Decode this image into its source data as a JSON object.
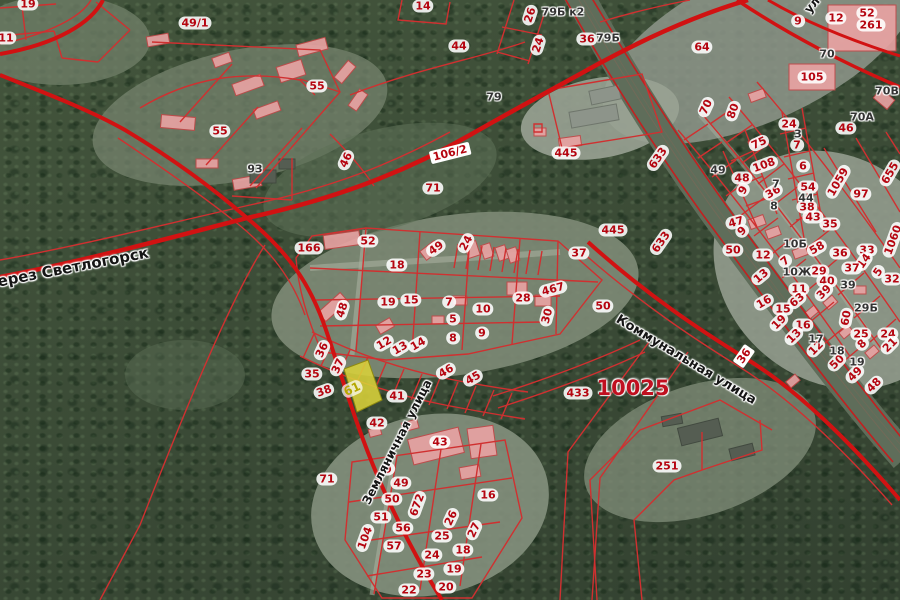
{
  "map": {
    "description": "Public cadastral map over satellite imagery",
    "colors": {
      "boundary_red": "#d11212",
      "thin_boundary_red": "#d03030",
      "parcel_label_red": "#b50510",
      "address_label_gray": "#333333",
      "street_label_black": "#151515",
      "highlight_yellow": "#d9d23a",
      "building_pink": "#e9a3a3",
      "forest_green": "#45523f"
    },
    "highlighted_parcel": {
      "t": "61",
      "x": 352,
      "y": 389,
      "a": -25
    },
    "street_labels": [
      {
        "t": "через Светлогорск",
        "x": 68,
        "y": 268,
        "a": -11,
        "s": 15
      },
      {
        "t": "Коммунальная улица",
        "x": 686,
        "y": 360,
        "a": 31,
        "s": 13
      },
      {
        "t": "Земляничная улица",
        "x": 397,
        "y": 442,
        "a": -63,
        "s": 12
      },
      {
        "t": "ул",
        "x": 812,
        "y": 5,
        "a": -50,
        "s": 12
      }
    ],
    "road_shields": [
      {
        "t": "106/2",
        "x": 450,
        "y": 153,
        "a": -14
      },
      {
        "t": "36",
        "x": 744,
        "y": 356,
        "a": -55
      }
    ],
    "large_area_labels": [
      {
        "t": "10025",
        "x": 633,
        "y": 388,
        "a": 0
      }
    ],
    "parcel_numbers_red": [
      {
        "t": "19",
        "x": 28,
        "y": 4,
        "a": 0
      },
      {
        "t": "11",
        "x": 6,
        "y": 38,
        "a": 0
      },
      {
        "t": "49/1",
        "x": 195,
        "y": 23,
        "a": 0
      },
      {
        "t": "55",
        "x": 220,
        "y": 131,
        "a": 0
      },
      {
        "t": "55",
        "x": 317,
        "y": 86,
        "a": 0
      },
      {
        "t": "14",
        "x": 423,
        "y": 6,
        "a": 0
      },
      {
        "t": "44",
        "x": 459,
        "y": 46,
        "a": 0
      },
      {
        "t": "26",
        "x": 530,
        "y": 15,
        "a": -72
      },
      {
        "t": "24",
        "x": 538,
        "y": 45,
        "a": -72
      },
      {
        "t": "36",
        "x": 587,
        "y": 39,
        "a": 0
      },
      {
        "t": "64",
        "x": 702,
        "y": 47,
        "a": 0
      },
      {
        "t": "9",
        "x": 798,
        "y": 21,
        "a": 0
      },
      {
        "t": "12",
        "x": 836,
        "y": 18,
        "a": 0
      },
      {
        "t": "52",
        "x": 867,
        "y": 13,
        "a": 0
      },
      {
        "t": "261",
        "x": 871,
        "y": 25,
        "a": 0
      },
      {
        "t": "46",
        "x": 346,
        "y": 160,
        "a": -65
      },
      {
        "t": "445",
        "x": 566,
        "y": 153,
        "a": 0
      },
      {
        "t": "71",
        "x": 433,
        "y": 188,
        "a": 0
      },
      {
        "t": "633",
        "x": 658,
        "y": 158,
        "a": -55
      },
      {
        "t": "633",
        "x": 661,
        "y": 242,
        "a": -55
      },
      {
        "t": "445",
        "x": 613,
        "y": 230,
        "a": 0
      },
      {
        "t": "70",
        "x": 706,
        "y": 107,
        "a": -65
      },
      {
        "t": "80",
        "x": 733,
        "y": 111,
        "a": -70
      },
      {
        "t": "105",
        "x": 812,
        "y": 77,
        "a": 0
      },
      {
        "t": "24",
        "x": 789,
        "y": 124,
        "a": 0
      },
      {
        "t": "7",
        "x": 797,
        "y": 145,
        "a": 0
      },
      {
        "t": "46",
        "x": 846,
        "y": 128,
        "a": 0
      },
      {
        "t": "75",
        "x": 759,
        "y": 143,
        "a": -25
      },
      {
        "t": "108",
        "x": 764,
        "y": 165,
        "a": -20
      },
      {
        "t": "36",
        "x": 773,
        "y": 192,
        "a": -30
      },
      {
        "t": "9",
        "x": 743,
        "y": 190,
        "a": -60
      },
      {
        "t": "48",
        "x": 742,
        "y": 178,
        "a": 0
      },
      {
        "t": "6",
        "x": 803,
        "y": 166,
        "a": 0
      },
      {
        "t": "54",
        "x": 808,
        "y": 187,
        "a": 0
      },
      {
        "t": "38",
        "x": 807,
        "y": 207,
        "a": 0
      },
      {
        "t": "43",
        "x": 813,
        "y": 217,
        "a": 0
      },
      {
        "t": "35",
        "x": 830,
        "y": 224,
        "a": 0
      },
      {
        "t": "1059",
        "x": 838,
        "y": 182,
        "a": -60
      },
      {
        "t": "97",
        "x": 861,
        "y": 194,
        "a": 0
      },
      {
        "t": "655",
        "x": 890,
        "y": 173,
        "a": -60
      },
      {
        "t": "1060",
        "x": 893,
        "y": 240,
        "a": -70
      },
      {
        "t": "47",
        "x": 736,
        "y": 222,
        "a": -15
      },
      {
        "t": "9",
        "x": 742,
        "y": 231,
        "a": -45
      },
      {
        "t": "50",
        "x": 733,
        "y": 250,
        "a": 0
      },
      {
        "t": "12",
        "x": 763,
        "y": 255,
        "a": 0
      },
      {
        "t": "13",
        "x": 761,
        "y": 276,
        "a": -40
      },
      {
        "t": "58",
        "x": 817,
        "y": 248,
        "a": -30
      },
      {
        "t": "36",
        "x": 840,
        "y": 253,
        "a": 0
      },
      {
        "t": "33",
        "x": 867,
        "y": 250,
        "a": 0
      },
      {
        "t": "14",
        "x": 864,
        "y": 261,
        "a": -55
      },
      {
        "t": "37",
        "x": 852,
        "y": 268,
        "a": 0
      },
      {
        "t": "5",
        "x": 878,
        "y": 272,
        "a": -55
      },
      {
        "t": "32",
        "x": 892,
        "y": 279,
        "a": 0
      },
      {
        "t": "29",
        "x": 819,
        "y": 271,
        "a": 0
      },
      {
        "t": "40",
        "x": 827,
        "y": 281,
        "a": 0
      },
      {
        "t": "39",
        "x": 824,
        "y": 292,
        "a": -45
      },
      {
        "t": "11",
        "x": 799,
        "y": 289,
        "a": 0
      },
      {
        "t": "63",
        "x": 797,
        "y": 300,
        "a": -40
      },
      {
        "t": "7",
        "x": 785,
        "y": 261,
        "a": -40
      },
      {
        "t": "16",
        "x": 764,
        "y": 302,
        "a": -30
      },
      {
        "t": "15",
        "x": 783,
        "y": 309,
        "a": 0
      },
      {
        "t": "19",
        "x": 779,
        "y": 322,
        "a": -45
      },
      {
        "t": "16",
        "x": 803,
        "y": 325,
        "a": 0
      },
      {
        "t": "13",
        "x": 794,
        "y": 336,
        "a": -45
      },
      {
        "t": "12",
        "x": 816,
        "y": 348,
        "a": -45
      },
      {
        "t": "50",
        "x": 837,
        "y": 362,
        "a": -45
      },
      {
        "t": "49",
        "x": 855,
        "y": 374,
        "a": -45
      },
      {
        "t": "48",
        "x": 874,
        "y": 385,
        "a": -45
      },
      {
        "t": "60",
        "x": 846,
        "y": 318,
        "a": -80
      },
      {
        "t": "25",
        "x": 861,
        "y": 334,
        "a": 0
      },
      {
        "t": "24",
        "x": 888,
        "y": 334,
        "a": 0
      },
      {
        "t": "8",
        "x": 862,
        "y": 344,
        "a": -45
      },
      {
        "t": "21",
        "x": 890,
        "y": 345,
        "a": -45
      },
      {
        "t": "166",
        "x": 309,
        "y": 248,
        "a": 0
      },
      {
        "t": "52",
        "x": 368,
        "y": 241,
        "a": 0
      },
      {
        "t": "49",
        "x": 436,
        "y": 248,
        "a": -35
      },
      {
        "t": "24",
        "x": 466,
        "y": 243,
        "a": -62
      },
      {
        "t": "37",
        "x": 579,
        "y": 253,
        "a": 0
      },
      {
        "t": "18",
        "x": 397,
        "y": 265,
        "a": 0
      },
      {
        "t": "19",
        "x": 388,
        "y": 302,
        "a": 0
      },
      {
        "t": "15",
        "x": 411,
        "y": 300,
        "a": 0
      },
      {
        "t": "48",
        "x": 342,
        "y": 310,
        "a": -72
      },
      {
        "t": "7",
        "x": 449,
        "y": 302,
        "a": 0
      },
      {
        "t": "5",
        "x": 453,
        "y": 319,
        "a": 0
      },
      {
        "t": "8",
        "x": 453,
        "y": 338,
        "a": 0
      },
      {
        "t": "10",
        "x": 483,
        "y": 309,
        "a": 0
      },
      {
        "t": "9",
        "x": 482,
        "y": 333,
        "a": 0
      },
      {
        "t": "28",
        "x": 523,
        "y": 298,
        "a": 0
      },
      {
        "t": "467",
        "x": 553,
        "y": 289,
        "a": -15
      },
      {
        "t": "30",
        "x": 547,
        "y": 316,
        "a": -75
      },
      {
        "t": "50",
        "x": 603,
        "y": 306,
        "a": 0
      },
      {
        "t": "12",
        "x": 384,
        "y": 343,
        "a": -30
      },
      {
        "t": "13",
        "x": 400,
        "y": 348,
        "a": -30
      },
      {
        "t": "14",
        "x": 418,
        "y": 344,
        "a": -30
      },
      {
        "t": "36",
        "x": 322,
        "y": 350,
        "a": -65
      },
      {
        "t": "37",
        "x": 338,
        "y": 366,
        "a": -65
      },
      {
        "t": "35",
        "x": 312,
        "y": 374,
        "a": 0
      },
      {
        "t": "38",
        "x": 324,
        "y": 391,
        "a": -20
      },
      {
        "t": "41",
        "x": 397,
        "y": 396,
        "a": 0
      },
      {
        "t": "42",
        "x": 377,
        "y": 423,
        "a": 0
      },
      {
        "t": "46",
        "x": 446,
        "y": 371,
        "a": -30
      },
      {
        "t": "45",
        "x": 473,
        "y": 378,
        "a": -30
      },
      {
        "t": "433",
        "x": 578,
        "y": 393,
        "a": 0
      },
      {
        "t": "43",
        "x": 440,
        "y": 442,
        "a": 0
      },
      {
        "t": "16",
        "x": 488,
        "y": 495,
        "a": 0
      },
      {
        "t": "9",
        "x": 388,
        "y": 469,
        "a": -20
      },
      {
        "t": "49",
        "x": 401,
        "y": 483,
        "a": 0
      },
      {
        "t": "50",
        "x": 392,
        "y": 499,
        "a": 0
      },
      {
        "t": "51",
        "x": 381,
        "y": 517,
        "a": 0
      },
      {
        "t": "56",
        "x": 403,
        "y": 528,
        "a": 0
      },
      {
        "t": "57",
        "x": 394,
        "y": 546,
        "a": 0
      },
      {
        "t": "104",
        "x": 365,
        "y": 538,
        "a": -70
      },
      {
        "t": "672",
        "x": 417,
        "y": 505,
        "a": -70
      },
      {
        "t": "26",
        "x": 451,
        "y": 518,
        "a": -65
      },
      {
        "t": "27",
        "x": 474,
        "y": 530,
        "a": -65
      },
      {
        "t": "25",
        "x": 442,
        "y": 536,
        "a": 0
      },
      {
        "t": "24",
        "x": 432,
        "y": 555,
        "a": 0
      },
      {
        "t": "23",
        "x": 424,
        "y": 574,
        "a": 0
      },
      {
        "t": "22",
        "x": 409,
        "y": 590,
        "a": 0
      },
      {
        "t": "18",
        "x": 463,
        "y": 550,
        "a": 0
      },
      {
        "t": "19",
        "x": 454,
        "y": 569,
        "a": 0
      },
      {
        "t": "20",
        "x": 446,
        "y": 587,
        "a": 0
      },
      {
        "t": "71",
        "x": 327,
        "y": 479,
        "a": 0
      },
      {
        "t": "251",
        "x": 667,
        "y": 466,
        "a": 0
      }
    ],
    "building_numbers_gray": [
      {
        "t": "93",
        "x": 255,
        "y": 169,
        "a": 0
      },
      {
        "t": "79",
        "x": 494,
        "y": 97,
        "a": 0
      },
      {
        "t": "79Б к2",
        "x": 563,
        "y": 12,
        "a": 0
      },
      {
        "t": "79Б",
        "x": 608,
        "y": 38,
        "a": 0
      },
      {
        "t": "70",
        "x": 827,
        "y": 54,
        "a": 0
      },
      {
        "t": "70А",
        "x": 862,
        "y": 117,
        "a": 0
      },
      {
        "t": "70В",
        "x": 887,
        "y": 91,
        "a": 0
      },
      {
        "t": "49",
        "x": 718,
        "y": 170,
        "a": 0
      },
      {
        "t": "3",
        "x": 798,
        "y": 134,
        "a": 0
      },
      {
        "t": "7",
        "x": 776,
        "y": 184,
        "a": 0
      },
      {
        "t": "8",
        "x": 774,
        "y": 206,
        "a": 0
      },
      {
        "t": "44",
        "x": 806,
        "y": 198,
        "a": 0
      },
      {
        "t": "10Б",
        "x": 795,
        "y": 244,
        "a": 0
      },
      {
        "t": "10Ж",
        "x": 797,
        "y": 272,
        "a": 0
      },
      {
        "t": "29Б",
        "x": 866,
        "y": 308,
        "a": 0
      },
      {
        "t": "39",
        "x": 848,
        "y": 285,
        "a": 0
      },
      {
        "t": "17",
        "x": 816,
        "y": 339,
        "a": 0
      },
      {
        "t": "18",
        "x": 837,
        "y": 351,
        "a": 0
      },
      {
        "t": "19",
        "x": 857,
        "y": 362,
        "a": 0
      }
    ]
  }
}
